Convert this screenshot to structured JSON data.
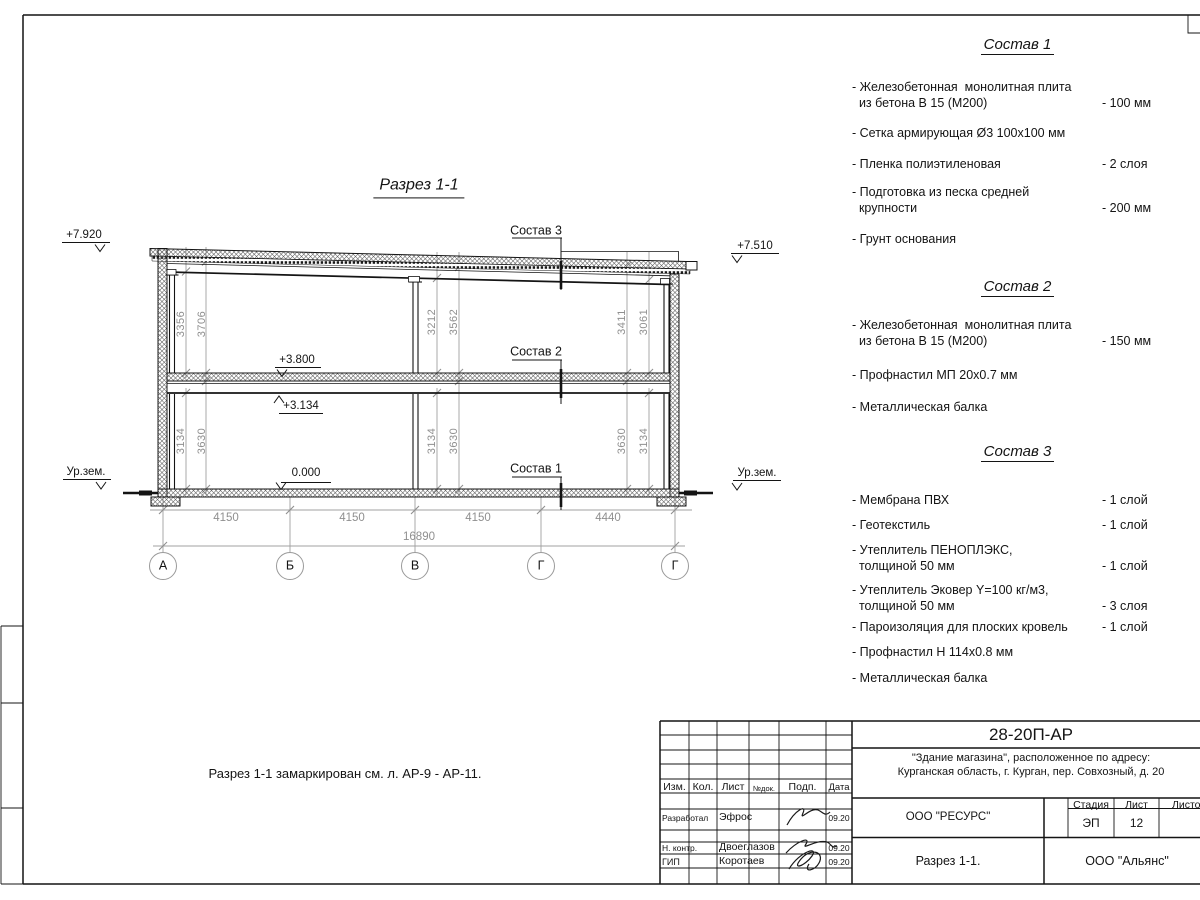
{
  "colors": {
    "paper": "#ffffff",
    "ink": "#141414",
    "dim_gray": "#8f8f8f"
  },
  "drawing": {
    "title": "Разрез 1-1",
    "note": "Разрез 1-1 замаркирован см. л. АР-9 - АР-11.",
    "labels": {
      "l3": "Состав 3",
      "l2": "Состав 2",
      "l1": "Состав 1"
    },
    "elevations": {
      "roof_left": "+7.920",
      "roof_right": "+7.510",
      "floor": "+3.800",
      "beam": "+3.134",
      "zero": "0.000",
      "ground_left": "Ур.зем.",
      "ground_right": "Ур.зем."
    },
    "vdims": {
      "u_left_1": "3356",
      "u_left_2": "3706",
      "u_mid_1": "3212",
      "u_mid_2": "3562",
      "u_right_1": "3411",
      "u_right_2": "3061",
      "l_left_1": "3134",
      "l_left_2": "3630",
      "l_mid_1": "3134",
      "l_mid_2": "3630",
      "l_right_1": "3630",
      "l_right_2": "3134"
    },
    "hdims": {
      "b1": "4150",
      "b2": "4150",
      "b3": "4150",
      "b4": "4440",
      "total": "16890"
    },
    "axes": [
      "А",
      "Б",
      "В",
      "Г",
      "Г"
    ]
  },
  "compositions": [
    {
      "title": "Состав 1",
      "items": [
        {
          "text": "- Железобетонная  монолитная плита\n  из бетона В 15 (М200)",
          "value": "- 100 мм"
        },
        {
          "text": "- Сетка армирующая Ø3 100х100 мм",
          "value": ""
        },
        {
          "text": "- Пленка полиэтиленовая",
          "value": "-  2 слоя"
        },
        {
          "text": "- Подготовка из песка средней\n  крупности",
          "value": "- 200 мм"
        },
        {
          "text": "- Грунт основания",
          "value": ""
        }
      ]
    },
    {
      "title": "Состав 2",
      "items": [
        {
          "text": "- Железобетонная  монолитная плита\n  из бетона В 15 (М200)",
          "value": "- 150 мм"
        },
        {
          "text": "- Профнастил МП 20х0.7 мм",
          "value": ""
        },
        {
          "text": "- Металлическая балка",
          "value": ""
        }
      ]
    },
    {
      "title": "Состав 3",
      "items": [
        {
          "text": "- Мембрана ПВХ",
          "value": "- 1 слой"
        },
        {
          "text": "- Геотекстиль",
          "value": "- 1 слой"
        },
        {
          "text": "- Утеплитель ПЕНОПЛЭКС,\n  толщиной 50 мм",
          "value": "- 1 слой"
        },
        {
          "text": "- Утеплитель Эковер Y=100 кг/м3,\n  толщиной 50 мм",
          "value": "- 3 слоя"
        },
        {
          "text": "- Пароизоляция для плоских кровель",
          "value": "- 1 слой"
        },
        {
          "text": "- Профнастил Н 114х0.8 мм",
          "value": ""
        },
        {
          "text": "- Металлическая балка",
          "value": ""
        }
      ]
    }
  ],
  "titleblock": {
    "doc_number": "28-20П-АР",
    "project_line1": "\"Здание магазина\", расположенное по адресу:",
    "project_line2": "Курганская область, г. Курган, пер. Совхозный, д. 20",
    "org": "ООО \"РЕСУРС\"",
    "sheet_title": "Разрез 1-1.",
    "company": "ООО \"Альянс\"",
    "stage_label": "Стадия",
    "sheet_label": "Лист",
    "sheets_label": "Листов",
    "stage": "ЭП",
    "sheet_num": "12",
    "cols": {
      "izm": "Изм.",
      "kol": "Кол.",
      "list": "Лист",
      "doc": "№док.",
      "podp": "Подп.",
      "data": "Дата"
    },
    "rows": [
      {
        "role": "Разработал",
        "name": "Эфрос",
        "date": "09.20"
      },
      {
        "role": "Н. контр.",
        "name": "Двоеглазов",
        "date": "09.20"
      },
      {
        "role": "ГИП",
        "name": "Коротаев",
        "date": "09.20"
      }
    ]
  }
}
